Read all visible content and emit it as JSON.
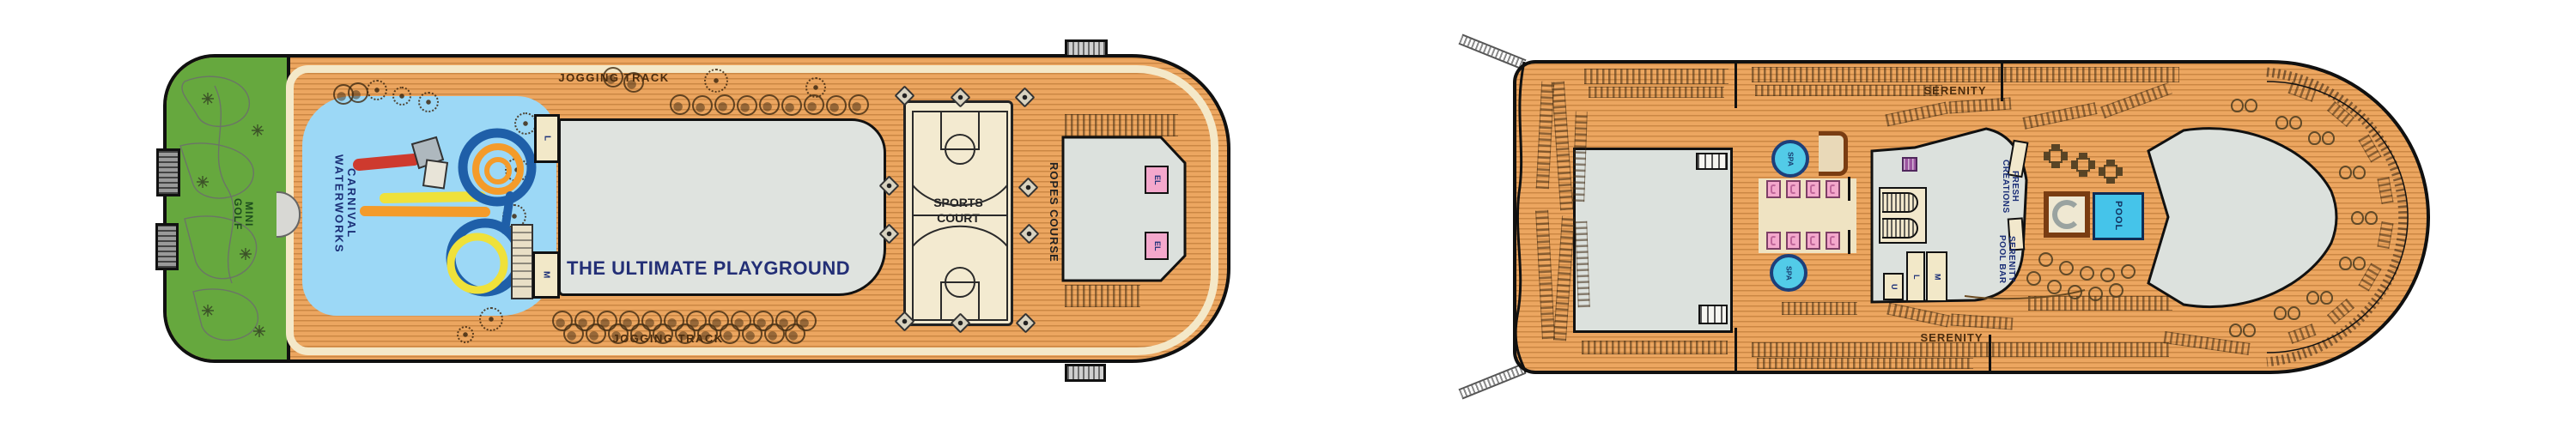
{
  "plan_colors": {
    "deck_wood": "#ECA660",
    "plank_line": "#B06E2C",
    "track_cream": "#F4E8C8",
    "mini_golf_green": "#66A83E",
    "water_blue": "#9CD8F6",
    "structure_gray": "#DCE1DD",
    "court_cream": "#F3EAD0",
    "elevator_pink": "#F4A8CC",
    "spa_cyan": "#52CBE8",
    "pool_cyan": "#45C4EA",
    "navy_text": "#1B2F77",
    "brown_text": "#4A2C0E",
    "slide_blue": "#1F5FA8",
    "slide_orange": "#F49B2A",
    "slide_yellow": "#EFE13A",
    "slide_red": "#CE3A2E",
    "bar_brown": "#7A3D12",
    "walkway_tan": "#EFE3C2",
    "towel_purple": "#9C55A0"
  },
  "left_deck": {
    "jogging_track_top": "JOGGING TRACK",
    "jogging_track_bottom": "JOGGING TRACK",
    "mini_golf_line1": "MINI",
    "mini_golf_line2": "GOLF",
    "waterworks_line1": "CARNIVAL",
    "waterworks_line2": "WATERWORKS",
    "playground_title": "THE ULTIMATE PLAYGROUND",
    "sports_court_line1": "SPORTS",
    "sports_court_line2": "COURT",
    "ropes_course": "ROPES COURSE",
    "stair_upper": "L",
    "stair_lower": "M",
    "elevator_1": "EL",
    "elevator_2": "EL"
  },
  "right_deck": {
    "serenity_top": "SERENITY",
    "serenity_bottom": "SERENITY",
    "spa_forward": "SPA",
    "spa_aft": "SPA",
    "fresh_creations_line1": "FRESH",
    "fresh_creations_line2": "CREATIONS",
    "pool_bar_line1": "SERENITY",
    "pool_bar_line2": "POOL BAR",
    "pool": "POOL",
    "room_u": "U",
    "room_l": "L",
    "room_m": "M"
  }
}
